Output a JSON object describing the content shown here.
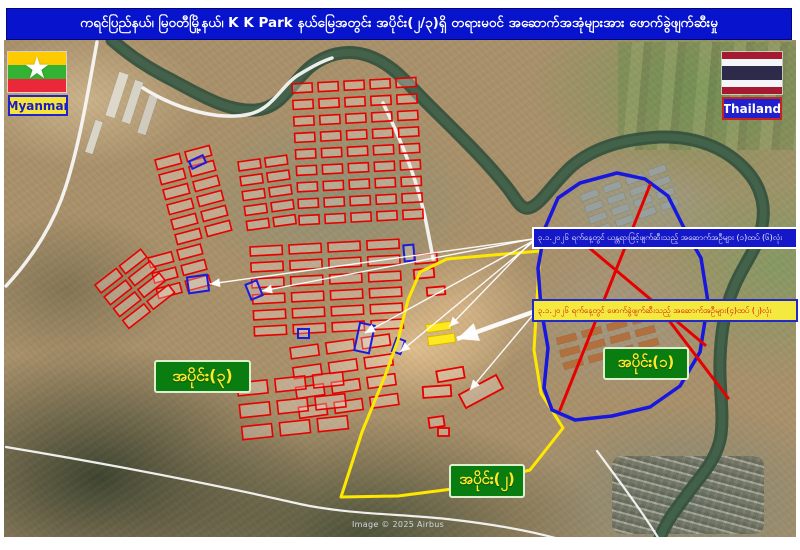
{
  "title": "ကရင်ပြည်နယ်၊ မြဝတီမြို့နယ်၊  K K Park နယ်မြေအတွင်း အပိုင်း(၂/၃)ရှိ တရားမဝင် အဆောက်အအုံများအား ဖောက်ခွဲဖျက်ဆီးမှု",
  "flags": {
    "myanmar_label": "Myanmar",
    "thailand_label": "Thailand"
  },
  "zone_labels": {
    "zone1": "အပိုင်း(၁)",
    "zone2": "အပိုင်း(၂)",
    "zone3": "အပိုင်း(၃)"
  },
  "callouts": {
    "machinery": "၃.၁.၂၀၂၆ ရက်နေ့တွင် ယန္တရားဖြင့်ဖျက်ဆီးသည့် အဆောက်အဦများ (၁)ထပ် (၆)လုံး",
    "explosion": "၃.၁.၂၀၂၆ ရက်နေ့တွင် ဖောက်ခွဲဖျက်ဆီးသည့် အဆောက်အဦများ(၄)ထပ် (၂)လုံး"
  },
  "attribution": "Image © 2025 Airbus",
  "colors": {
    "title_bg": "#0713cd",
    "river": "#36523e",
    "road": "#f7f7f5",
    "building_red": "#e60000",
    "building_blue": "#1b1bd9",
    "building_yellow": "#ffe81e",
    "zone1_outline": "#1717dd",
    "zone2_outline": "#ffe800",
    "red_x": "#e60000",
    "leader": "#ffffff",
    "label_green": "#0a7d10",
    "label_text": "#ffe92a"
  },
  "map_geometry": {
    "river": "M112,40 C130,56 152,70 172,80 C202,96 228,112 256,110 C282,108 290,84 310,67 C326,54 346,49 366,55 C392,63 406,82 426,102 C450,126 482,156 506,186 C516,198 520,210 529,208 C541,205 552,184 572,166 C596,146 626,139 660,137 C696,136 726,148 746,170 C761,186 766,206 762,226 C757,250 744,263 734,287 C725,308 721,330 720,360 C719,390 724,410 721,435 C717,461 700,476 686,496 C673,513 660,530 657,549",
    "roads": [
      "M97,42 C88,92 80,142 66,186 C55,221 34,256 6,286",
      "M143,88 C178,110 220,121 250,114 C274,108 282,84 300,74 C310,68 320,62 332,58",
      "M383,103 C402,142 418,182 426,222 C430,242 432,252 433,259",
      "M6,447 C90,461 190,479 300,504 C345,514 400,514 447,519 C492,524 540,532 575,544",
      "M597,451 C620,482 645,515 665,549"
    ],
    "zone1_outline": "617,173 580,183 558,198 545,228 538,268 541,308 548,348 544,388 552,410 575,420 612,416 650,407 680,386 700,352 708,302 701,258 686,232 668,196 645,179",
    "zone2_outline": "447,259 540,251 537,300 534,350 541,393 563,428 530,470 460,488 398,496 341,497 362,432 385,376 398,340 408,300 420,272",
    "red_lines": [
      [
        650,
        185,
        560,
        410
      ],
      [
        568,
        230,
        705,
        345
      ],
      [
        655,
        302,
        728,
        398
      ]
    ],
    "leader_lines": [
      {
        "x1": 533,
        "y1": 239,
        "x2": 210,
        "y2": 284
      },
      {
        "x1": 533,
        "y1": 239,
        "x2": 262,
        "y2": 291
      },
      {
        "x1": 533,
        "y1": 241,
        "x2": 365,
        "y2": 333
      },
      {
        "x1": 533,
        "y1": 242,
        "x2": 400,
        "y2": 352
      },
      {
        "x1": 533,
        "y1": 240,
        "x2": 449,
        "y2": 327
      },
      {
        "x1": 533,
        "y1": 312,
        "x2": 457,
        "y2": 339,
        "thick": true
      },
      {
        "x1": 533,
        "y1": 315,
        "x2": 470,
        "y2": 390
      }
    ],
    "red_clusters": [
      {
        "x": 292,
        "y": 84,
        "cols": 5,
        "rows": 9,
        "w": 20,
        "h": 9,
        "gx": 26,
        "gy": 16.5,
        "a": -3
      },
      {
        "x": 238,
        "y": 162,
        "cols": 2,
        "rows": 5,
        "w": 22,
        "h": 9,
        "gx": 27,
        "gy": 15,
        "a": -8
      },
      {
        "x": 155,
        "y": 160,
        "cols": 2,
        "rows": 6,
        "w": 25,
        "h": 10,
        "gx": 31,
        "gy": 15.5,
        "a": -15
      },
      {
        "x": 148,
        "y": 258,
        "cols": 2,
        "rows": 3,
        "w": 24,
        "h": 10,
        "gx": 30,
        "gy": 16,
        "a": -15
      },
      {
        "x": 250,
        "y": 247,
        "cols": 4,
        "rows": 6,
        "w": 32,
        "h": 9,
        "gx": 39,
        "gy": 16,
        "a": -3
      },
      {
        "x": 290,
        "y": 348,
        "cols": 3,
        "rows": 4,
        "w": 28,
        "h": 11,
        "gx": 36,
        "gy": 20,
        "a": -8
      },
      {
        "x": 95,
        "y": 285,
        "cols": 2,
        "rows": 4,
        "w": 27,
        "h": 10,
        "gx": 31,
        "gy": 15,
        "a": -38
      },
      {
        "x": 237,
        "y": 383,
        "cols": 3,
        "rows": 3,
        "w": 30,
        "h": 13,
        "gx": 38,
        "gy": 22,
        "a": -6
      }
    ],
    "red_singles": [
      {
        "x": 415,
        "y": 254,
        "w": 22,
        "h": 9,
        "a": -5
      },
      {
        "x": 414,
        "y": 269,
        "w": 20,
        "h": 9,
        "a": -5
      },
      {
        "x": 427,
        "y": 287,
        "w": 18,
        "h": 8,
        "a": -5
      },
      {
        "x": 437,
        "y": 369,
        "w": 27,
        "h": 11,
        "a": -10
      },
      {
        "x": 423,
        "y": 386,
        "w": 28,
        "h": 11,
        "a": -4
      },
      {
        "x": 460,
        "y": 384,
        "w": 42,
        "h": 15,
        "a": -28
      },
      {
        "x": 429,
        "y": 417,
        "w": 15,
        "h": 10,
        "a": -8
      },
      {
        "x": 438,
        "y": 428,
        "w": 11,
        "h": 8,
        "a": 0
      }
    ],
    "blue_buildings": [
      {
        "x": 190,
        "y": 158,
        "w": 15,
        "h": 8,
        "a": -25
      },
      {
        "x": 188,
        "y": 276,
        "w": 20,
        "h": 16,
        "a": -8
      },
      {
        "x": 248,
        "y": 282,
        "w": 12,
        "h": 16,
        "a": -22
      },
      {
        "x": 357,
        "y": 324,
        "w": 15,
        "h": 28,
        "a": 12
      },
      {
        "x": 404,
        "y": 245,
        "w": 10,
        "h": 16,
        "a": -5
      },
      {
        "x": 298,
        "y": 329,
        "w": 11,
        "h": 9,
        "a": 0
      },
      {
        "x": 394,
        "y": 339,
        "w": 9,
        "h": 14,
        "a": 20
      }
    ],
    "yellow_buildings": [
      {
        "x": 426,
        "y": 323,
        "w": 25,
        "h": 8,
        "a": -8
      },
      {
        "x": 428,
        "y": 335,
        "w": 27,
        "h": 9,
        "a": -8
      }
    ],
    "satellite_rects": [
      {
        "x": 112,
        "y": 72,
        "w": 10,
        "h": 46,
        "a": 18,
        "fill": "#ddd8ca"
      },
      {
        "x": 128,
        "y": 80,
        "w": 9,
        "h": 44,
        "a": 18,
        "fill": "#d6d2c4"
      },
      {
        "x": 143,
        "y": 95,
        "w": 9,
        "h": 40,
        "a": 18,
        "fill": "#cfcabb"
      },
      {
        "x": 90,
        "y": 120,
        "w": 8,
        "h": 34,
        "a": 18,
        "fill": "#d8d4c6"
      }
    ],
    "satellite_clusters": [
      {
        "x": 556,
        "y": 338,
        "cols": 4,
        "rows": 3,
        "w": 20,
        "h": 7,
        "gx": 26,
        "gy": 13,
        "a": -15,
        "fill": "#b3703f"
      },
      {
        "x": 580,
        "y": 195,
        "cols": 4,
        "rows": 4,
        "w": 18,
        "h": 7,
        "gx": 24,
        "gy": 12,
        "a": -20,
        "fill": "#98a09e"
      }
    ]
  }
}
